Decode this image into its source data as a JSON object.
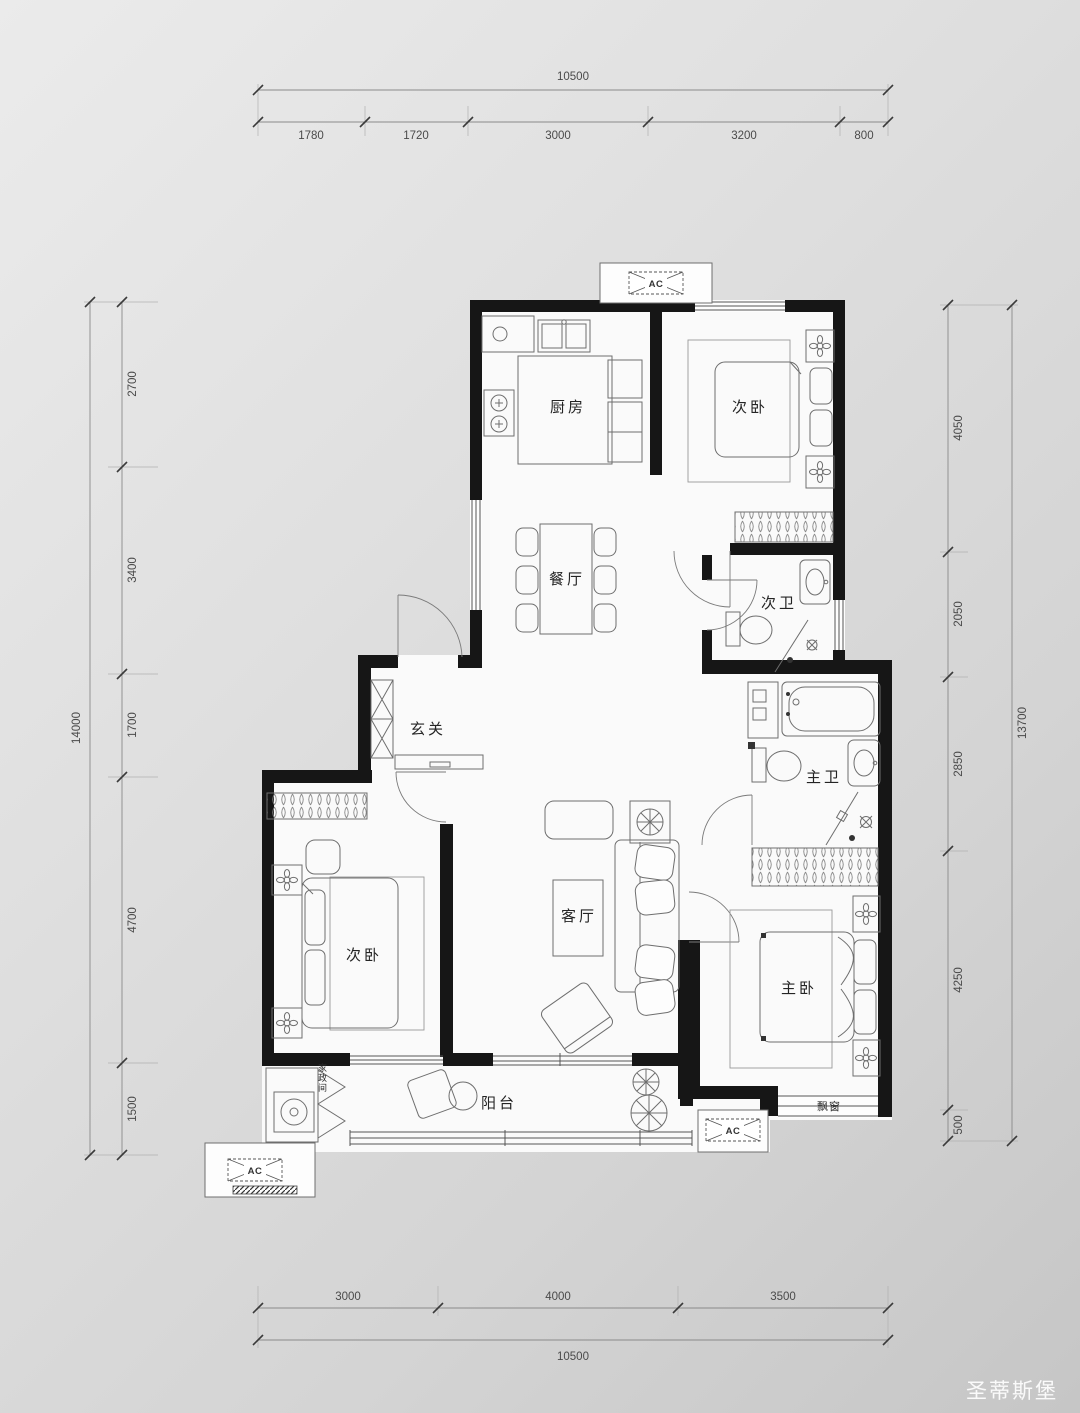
{
  "colors": {
    "wall": "#161616",
    "furniture_line": "#6e6e6e",
    "dimension_line": "#8a8a8a",
    "dimension_text": "#4a4a4a",
    "room_text": "#242424",
    "floor": "#fafafa",
    "background_light": "#ebebeb",
    "background_dark": "#c6c6c6",
    "watermark_text": "#ffffff"
  },
  "dimensions": {
    "top": {
      "total": "10500",
      "segments": [
        "1780",
        "1720",
        "3000",
        "3200",
        "800"
      ]
    },
    "bottom": {
      "total": "10500",
      "segments": [
        "3000",
        "4000",
        "3500"
      ]
    },
    "left": {
      "total": "14000",
      "segments": [
        "2700",
        "3400",
        "1700",
        "4700",
        "1500"
      ]
    },
    "right": {
      "total": "13700",
      "segments": [
        "4050",
        "2050",
        "2850",
        "4250",
        "500"
      ]
    }
  },
  "rooms": {
    "kitchen": "厨房",
    "bedroom2": "次卧",
    "dining": "餐厅",
    "bath2": "次卫",
    "entry": "玄关",
    "master_bath": "主卫",
    "bedroom3": "次卧",
    "living": "客厅",
    "master_bedroom": "主卧",
    "balcony": "阳台",
    "bay_window": "飘窗",
    "utility": "家政间"
  },
  "labels": {
    "ac": "AC"
  },
  "watermark": {
    "text": "圣蒂斯堡"
  }
}
